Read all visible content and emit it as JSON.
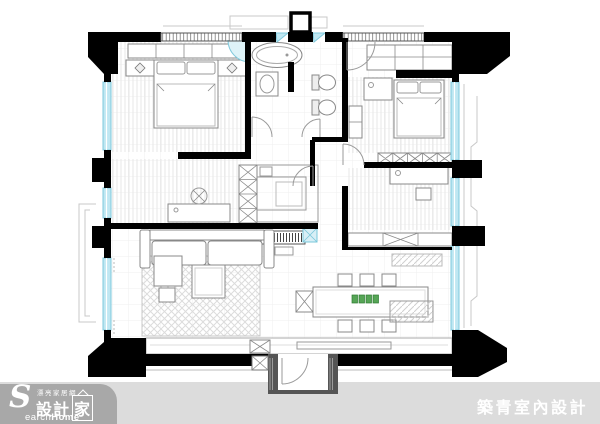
{
  "footer": {
    "band_color": "#dcdcdc",
    "logo": {
      "pill_color": "#a8a8a8",
      "tagline": "漂亮家居網",
      "initial": "S",
      "brand": "設計",
      "brand_house": "家",
      "latin_light": "earch",
      "latin_bold": "Home"
    },
    "credit": {
      "text": "築青室內設計",
      "color": "#ffffff"
    }
  },
  "plan": {
    "colors": {
      "wall": "#000000",
      "window": "#bfe7f2",
      "furniture_line": "#888888",
      "floor_grid": "#efefef",
      "rug_hatch": "#dcdcdc",
      "placemat_green": "#56a556",
      "vestibule_gray": "#555555"
    },
    "elements": [
      "double-bed-icon",
      "double-bed-icon-2",
      "bathtub-icon",
      "toilet-icon",
      "sink-icon",
      "wardrobe-x-icon",
      "desk-icon",
      "chair-icon",
      "sofa-icon",
      "coffee-table-icon",
      "rug-icon",
      "dining-table-icon",
      "dining-chair-icon",
      "placemat-icon",
      "kitchen-counter-icon",
      "tv-cabinet-icon",
      "entry-door-icon",
      "window-icon",
      "pillar-icon",
      "balcony-icon",
      "shaft-icon"
    ]
  }
}
